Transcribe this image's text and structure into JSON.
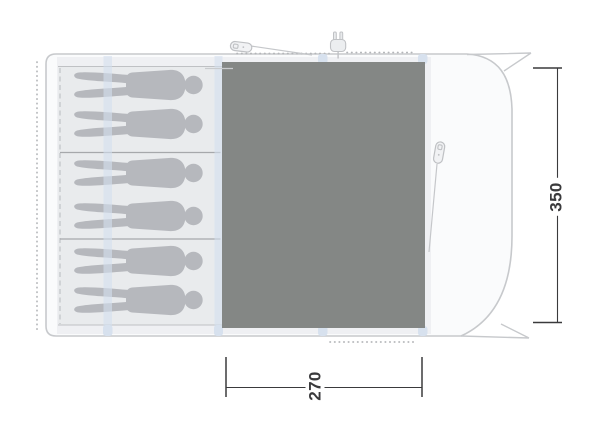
{
  "diagram": {
    "kind": "awning-floorplan-top-view",
    "dimension_labels": {
      "depth": "350",
      "width": "270"
    },
    "sleeping_area": {
      "compartments": 3,
      "sleepers": 6
    },
    "icons": {
      "peg": "peg-icon",
      "power_plug": "power-plug-icon",
      "person": "person-silhouette-icon"
    },
    "colors": {
      "groundsheet": "#848785",
      "sleeping_bg": "#e9ebed",
      "floor_band": "#eff0f3",
      "figure": "#b6b8bd",
      "pole": "#d7e1ee",
      "outline": "#c7c9cc",
      "dots": "#b4b6b9",
      "divider": "#a6a8ab",
      "dimension": "#3a3a3c"
    }
  }
}
